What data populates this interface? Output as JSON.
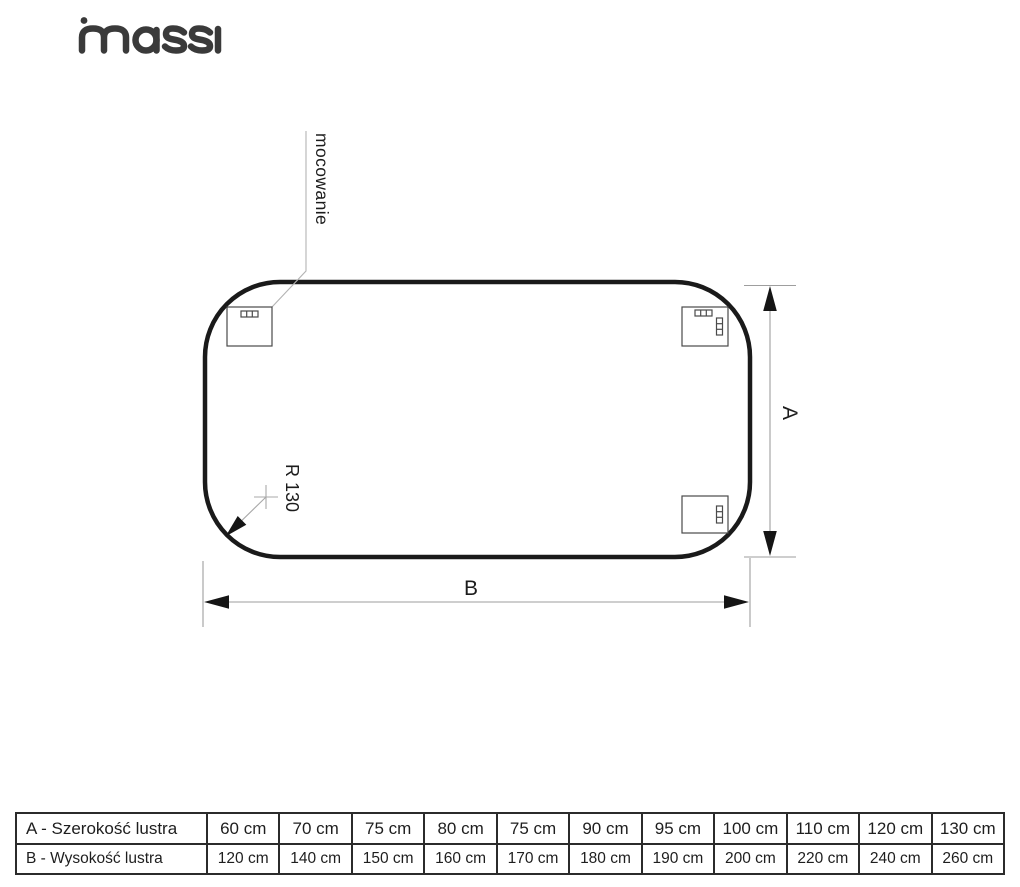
{
  "logo": {
    "text": "massi",
    "color": "#3a3a3a"
  },
  "diagram": {
    "mounting_label": "mocowanie",
    "radius_label": "R 130",
    "height_dim_label": "A",
    "width_dim_label": "B"
  },
  "size_table": {
    "rows": [
      {
        "label": "A - Szerokość lustra",
        "values": [
          "60 cm",
          "70 cm",
          "75 cm",
          "80 cm",
          "75 cm",
          "90 cm",
          "95 cm",
          "100 cm",
          "110 cm",
          "120 cm",
          "130 cm"
        ]
      },
      {
        "label": "B - Wysokość lustra",
        "values": [
          "120 cm",
          "140 cm",
          "150 cm",
          "160 cm",
          "170 cm",
          "180 cm",
          "190 cm",
          "200 cm",
          "220 cm",
          "240 cm",
          "260 cm"
        ]
      }
    ]
  },
  "colors": {
    "outline": "#1a1a1a",
    "thin_line": "#9e9e9e",
    "bracket_line": "#4a4a4a",
    "text": "#1c1c1c"
  }
}
